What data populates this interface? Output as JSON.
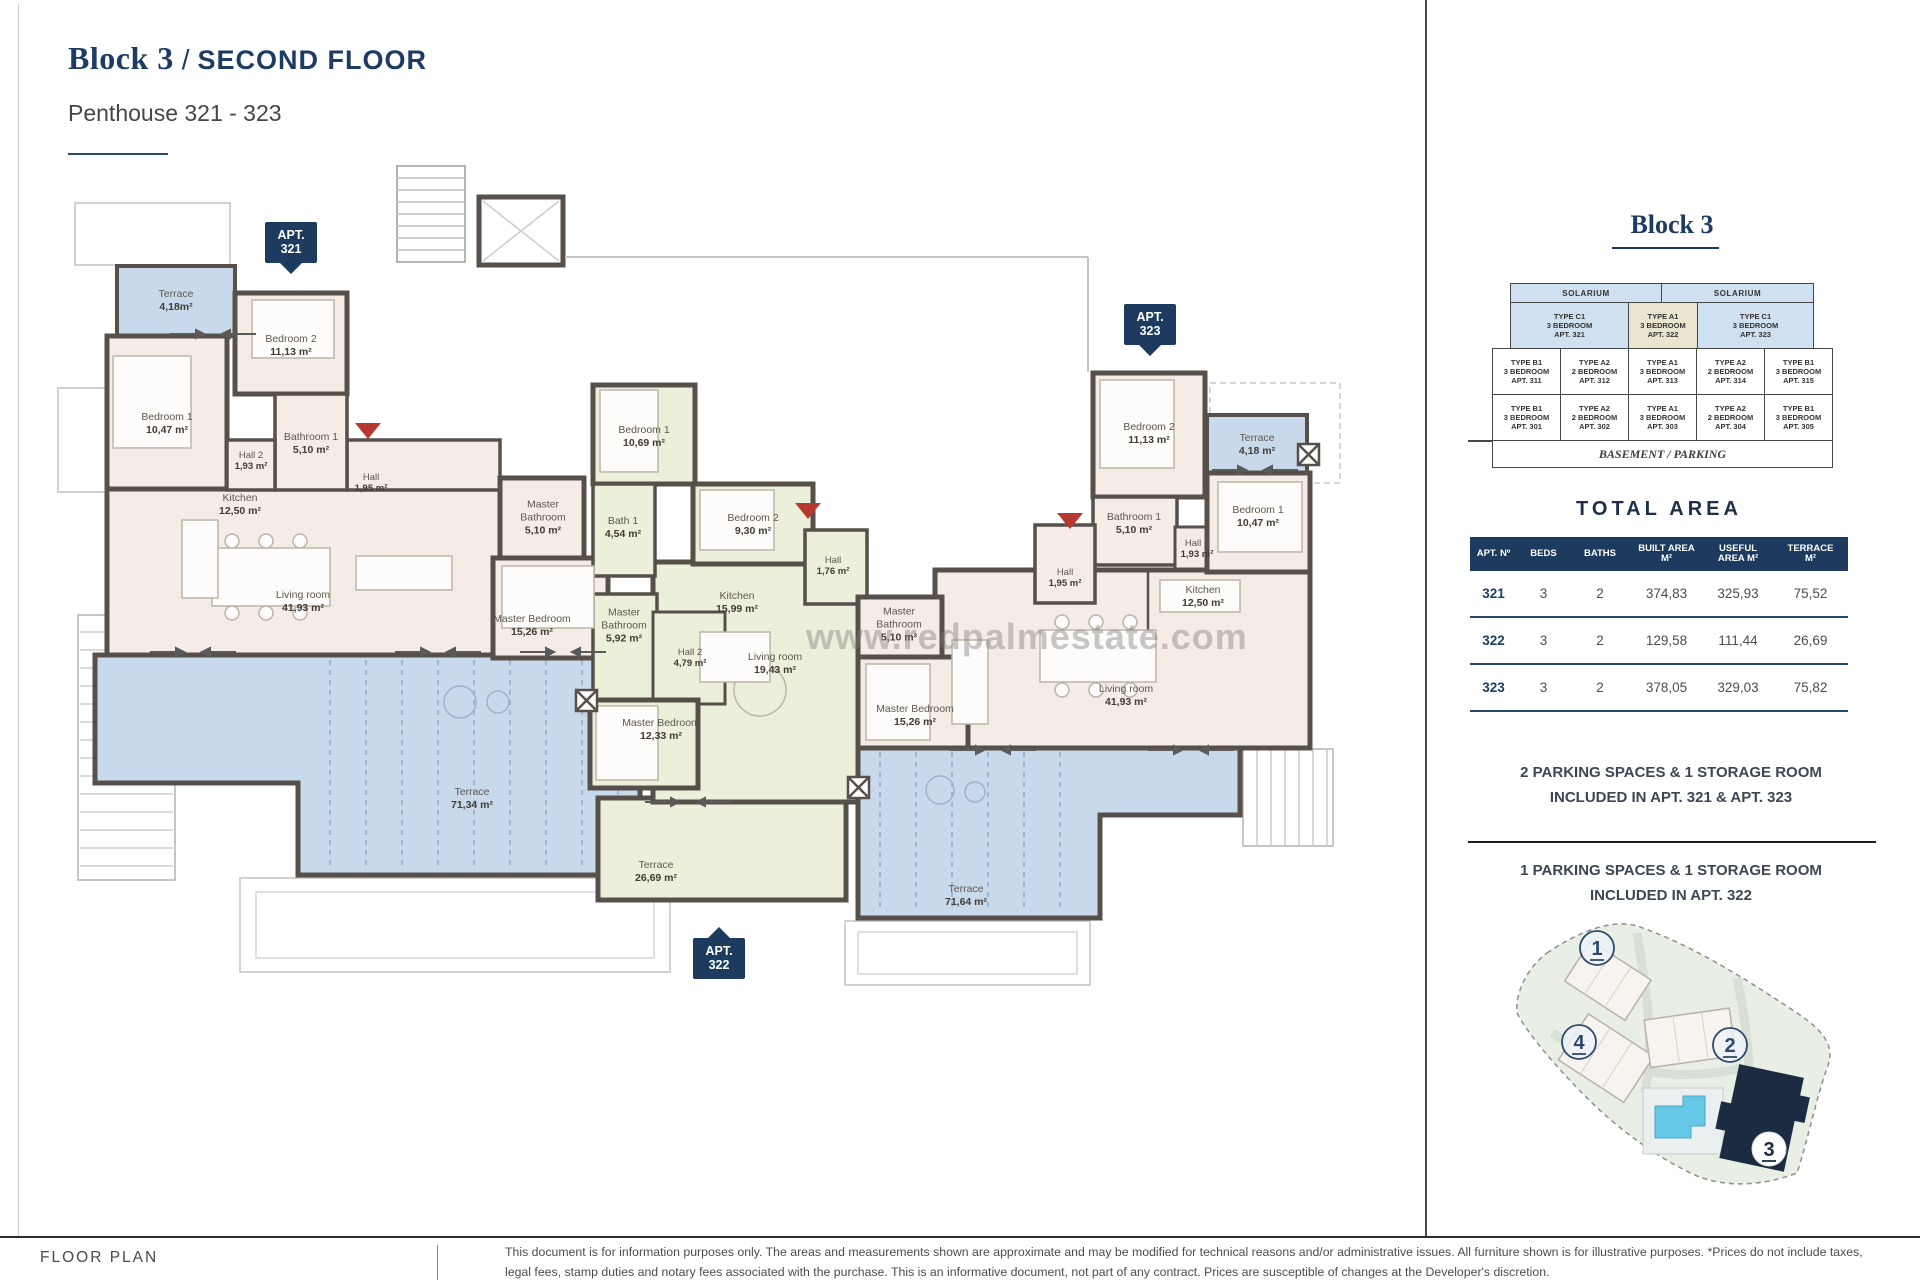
{
  "header": {
    "title_block": "Block 3",
    "title_slash": "/",
    "title_floor": "SECOND FLOOR",
    "subtitle": "Penthouse 321 - 323"
  },
  "watermark": "www.redpalmestate.com",
  "colors": {
    "navy": "#1c3b5e",
    "wall": "#57504a",
    "beige_unit": "#f5ece6",
    "green_unit": "#ecf0da",
    "terrace_blue": "#c9d9ec",
    "highlight_tan": "#e9e5cf",
    "entrance_red": "#b5392e"
  },
  "plan": {
    "apt321": {
      "badge_l1": "APT.",
      "badge_l2": "321",
      "rooms": {
        "tsmall": {
          "name": "Terrace",
          "area": "4,18m²"
        },
        "bed2": {
          "name": "Bedroom 2",
          "area": "11,13 m²"
        },
        "bed1": {
          "name": "Bedroom 1",
          "area": "10,47 m²"
        },
        "bath1": {
          "name": "Bathroom 1",
          "area": "5,10 m²"
        },
        "hall2": {
          "name": "Hall 2",
          "area": "1,93 m²"
        },
        "hall": {
          "name": "Hall",
          "area": "1,95 m²"
        },
        "kitchen": {
          "name": "Kitchen",
          "area": "12,50 m²"
        },
        "living": {
          "name": "Living room",
          "area": "41,93 m²"
        },
        "mbath": {
          "name": "Master Bathroom",
          "area": "5,10 m²"
        },
        "mbed": {
          "name": "Master Bedroom",
          "area": "15,26 m²"
        },
        "tbig": {
          "name": "Terrace",
          "area": "71,34 m²"
        }
      }
    },
    "apt322": {
      "badge_l1": "APT.",
      "badge_l2": "322",
      "rooms": {
        "bed1": {
          "name": "Bedroom 1",
          "area": "10,69 m²"
        },
        "bath1": {
          "name": "Bath 1",
          "area": "4,54 m²"
        },
        "bed2": {
          "name": "Bedroom 2",
          "area": "9,30 m²"
        },
        "hall": {
          "name": "Hall",
          "area": "1,76 m²"
        },
        "kitchen": {
          "name": "Kitchen",
          "area": "15,99 m²"
        },
        "mbath": {
          "name": "Master Bathroom",
          "area": "5,92 m²"
        },
        "hall2": {
          "name": "Hall 2",
          "area": "4,79 m²"
        },
        "living": {
          "name": "Living room",
          "area": "19,43 m²"
        },
        "mbed": {
          "name": "Master Bedroom",
          "area": "12,33 m²"
        },
        "terrace": {
          "name": "Terrace",
          "area": "26,69 m²"
        }
      }
    },
    "apt323": {
      "badge_l1": "APT.",
      "badge_l2": "323",
      "rooms": {
        "bed2": {
          "name": "Bedroom 2",
          "area": "11,13 m²"
        },
        "tsmall": {
          "name": "Terrace",
          "area": "4,18 m²"
        },
        "bath1": {
          "name": "Bathroom 1",
          "area": "5,10 m²"
        },
        "hall2": {
          "name": "Hall 2",
          "area": "1,93 m²"
        },
        "bed1": {
          "name": "Bedroom 1",
          "area": "10,47 m²"
        },
        "hall": {
          "name": "Hall",
          "area": "1,95 m²"
        },
        "kitchen": {
          "name": "Kitchen",
          "area": "12,50 m²"
        },
        "mbath": {
          "name": "Master Bathroom",
          "area": "5,10 m²"
        },
        "mbed": {
          "name": "Master Bedroom",
          "area": "15,26 m²"
        },
        "living": {
          "name": "Living room",
          "area": "41,93 m²"
        },
        "tbig": {
          "name": "Terrace",
          "area": "71,64 m²"
        }
      }
    }
  },
  "block3_panel": {
    "heading": "Block 3",
    "stack": {
      "solarium": [
        "SOLARIUM",
        "SOLARIUM"
      ],
      "penthouse": [
        {
          "type": "TYPE C1",
          "beds": "3 BEDROOM",
          "apt": "APT. 321"
        },
        {
          "type": "TYPE A1",
          "beds": "3 BEDROOM",
          "apt": "APT. 322"
        },
        {
          "type": "TYPE C1",
          "beds": "3 BEDROOM",
          "apt": "APT. 323"
        }
      ],
      "floor1": [
        {
          "type": "TYPE B1",
          "beds": "3 BEDROOM",
          "apt": "APT. 311"
        },
        {
          "type": "TYPE A2",
          "beds": "2 BEDROOM",
          "apt": "APT. 312"
        },
        {
          "type": "TYPE A1",
          "beds": "3 BEDROOM",
          "apt": "APT. 313"
        },
        {
          "type": "TYPE A2",
          "beds": "2 BEDROOM",
          "apt": "APT. 314"
        },
        {
          "type": "TYPE B1",
          "beds": "3 BEDROOM",
          "apt": "APT. 315"
        }
      ],
      "floor0": [
        {
          "type": "TYPE B1",
          "beds": "3 BEDROOM",
          "apt": "APT. 301"
        },
        {
          "type": "TYPE A2",
          "beds": "2 BEDROOM",
          "apt": "APT. 302"
        },
        {
          "type": "TYPE A1",
          "beds": "3 BEDROOM",
          "apt": "APT. 303"
        },
        {
          "type": "TYPE A2",
          "beds": "2 BEDROOM",
          "apt": "APT. 304"
        },
        {
          "type": "TYPE B1",
          "beds": "3 BEDROOM",
          "apt": "APT. 305"
        }
      ],
      "basement": "BASEMENT / PARKING"
    }
  },
  "total_area": {
    "heading": "TOTAL AREA",
    "headers": [
      "APT. Nº",
      "BEDS",
      "BATHS",
      "BUILT AREA M²",
      "USEFUL AREA M²",
      "TERRACE M²"
    ],
    "rows": [
      [
        "321",
        "3",
        "2",
        "374,83",
        "325,93",
        "75,52"
      ],
      [
        "322",
        "3",
        "2",
        "129,58",
        "111,44",
        "26,69"
      ],
      [
        "323",
        "3",
        "2",
        "378,05",
        "329,03",
        "75,82"
      ]
    ]
  },
  "parking": {
    "note1_l1": "2 PARKING SPACES & 1 STORAGE ROOM",
    "note1_l2": "INCLUDED IN APT. 321 & APT. 323",
    "note2_l1": "1 PARKING SPACES & 1 STORAGE ROOM",
    "note2_l2": "INCLUDED IN APT. 322"
  },
  "sitemap": {
    "b1": "1",
    "b2": "2",
    "b3": "3",
    "b4": "4"
  },
  "footer": {
    "label": "FLOOR PLAN",
    "disclaimer": "This document is for information purposes only. The areas and measurements shown are approximate and may be modified for technical reasons and/or administrative issues. All furniture shown is for illustrative purposes. *Prices do not include taxes, legal fees, stamp duties and notary fees associated with the purchase. This is an informative document, not part of any contract. Prices are susceptible of changes at the Developer's discretion."
  }
}
